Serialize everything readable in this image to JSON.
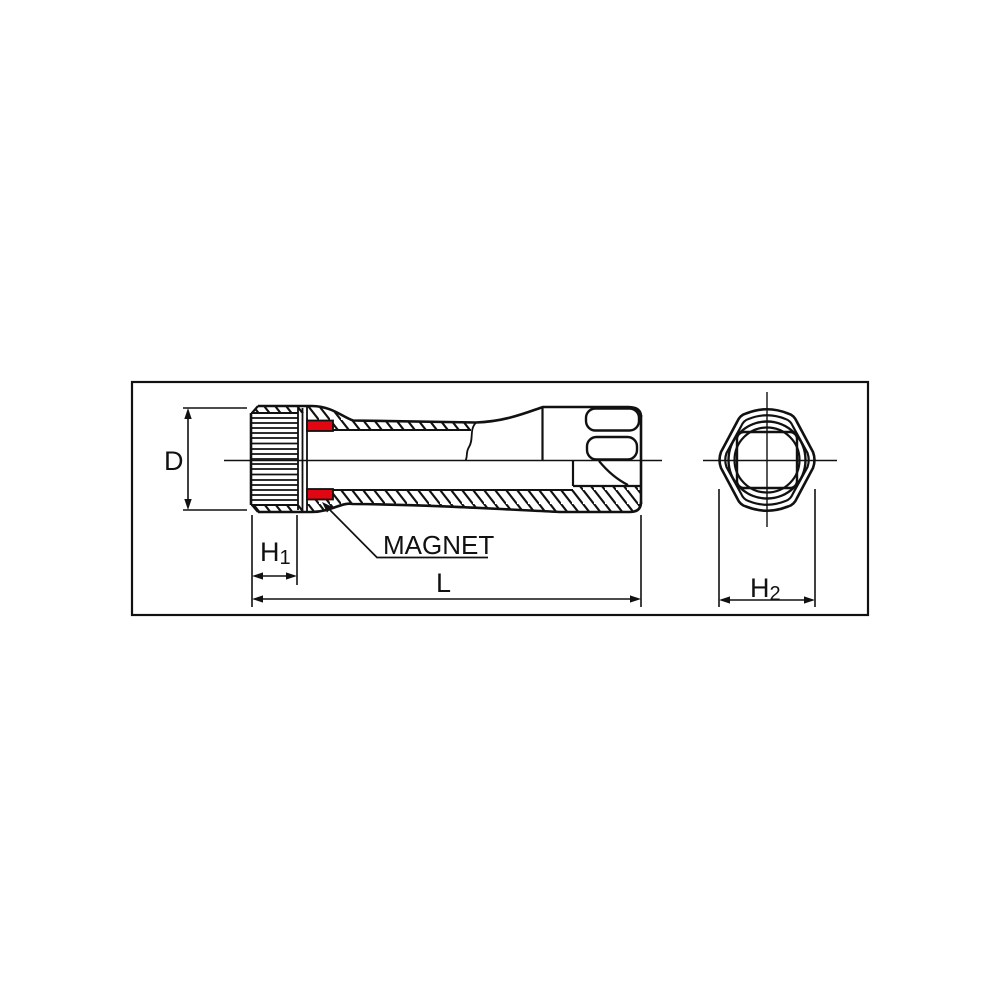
{
  "diagram": {
    "kind": "technical-drawing",
    "subject": "spark plug socket with magnet — side cross-section and hex end view",
    "labels": {
      "diameter": "D",
      "h1_main": "H",
      "h1_sub": "1",
      "length": "L",
      "h2_main": "H",
      "h2_sub": "2",
      "magnet_callout": "MAGNET"
    },
    "colors": {
      "line": "#111111",
      "magnet_red": "#e00713",
      "background": "#ffffff"
    }
  }
}
